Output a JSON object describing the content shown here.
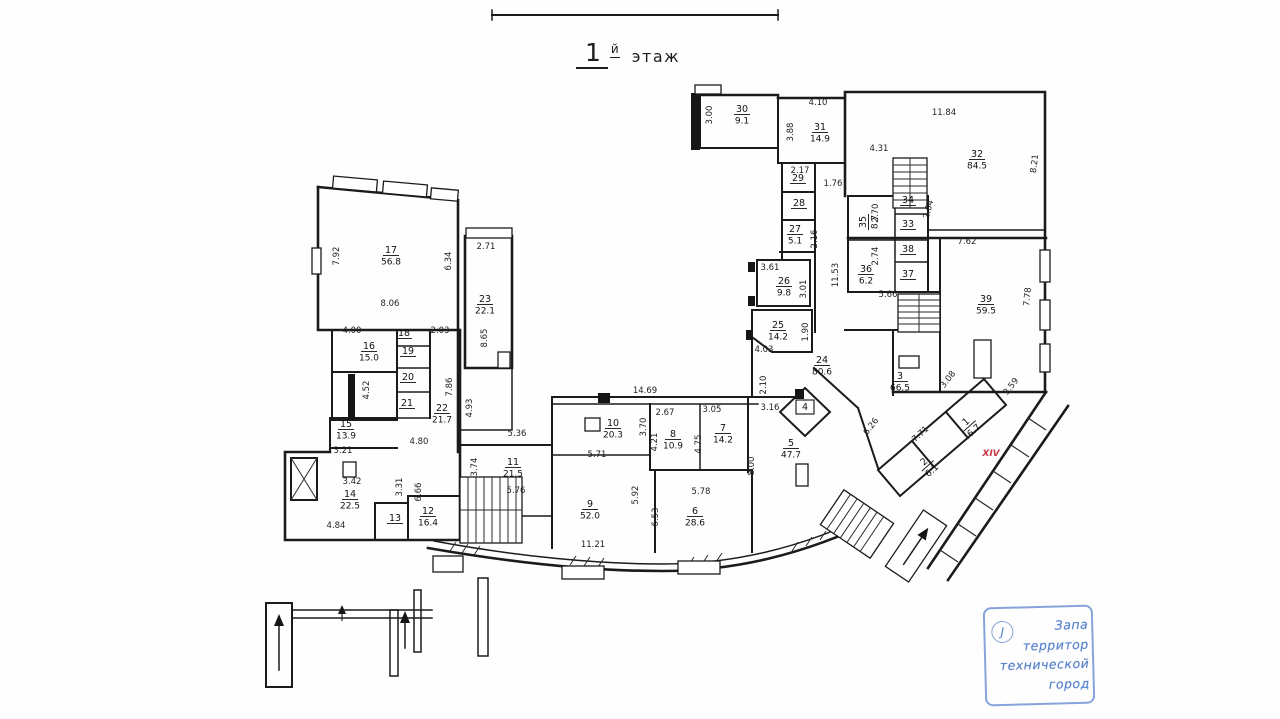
{
  "title": {
    "number": "1",
    "suffix": "й",
    "word": "этаж"
  },
  "colors": {
    "wall": "#1b1b1b",
    "dim_text": "#1f1f1f",
    "accent_red": "#c93545",
    "stamp_blue": "#537fc9"
  },
  "special_labels": [
    {
      "text": "XIV",
      "x": 991,
      "y": 456,
      "color": "#c93545"
    }
  ],
  "stamp": {
    "initial": "J",
    "lines": [
      "Запа",
      "территор",
      "технической",
      "город"
    ]
  },
  "rooms": [
    {
      "n": "1",
      "area": "6.7",
      "x": 968,
      "y": 424,
      "r": -42
    },
    {
      "n": "2",
      "area": "6.1",
      "x": 926,
      "y": 464,
      "r": -42
    },
    {
      "n": "3",
      "area": "66.5",
      "x": 900,
      "y": 379
    },
    {
      "n": "4",
      "area": "",
      "x": 805,
      "y": 410,
      "boxed": true
    },
    {
      "n": "5",
      "area": "47.7",
      "x": 791,
      "y": 446
    },
    {
      "n": "6",
      "area": "28.6",
      "x": 695,
      "y": 514
    },
    {
      "n": "7",
      "area": "14.2",
      "x": 723,
      "y": 431
    },
    {
      "n": "8",
      "area": "10.9",
      "x": 673,
      "y": 437
    },
    {
      "n": "9",
      "area": "52.0",
      "x": 590,
      "y": 507
    },
    {
      "n": "10",
      "area": "20.3",
      "x": 613,
      "y": 426
    },
    {
      "n": "11",
      "area": "21.5",
      "x": 513,
      "y": 465
    },
    {
      "n": "12",
      "area": "16.4",
      "x": 428,
      "y": 514
    },
    {
      "n": "13",
      "area": "",
      "x": 395,
      "y": 521
    },
    {
      "n": "14",
      "area": "22.5",
      "x": 350,
      "y": 497
    },
    {
      "n": "15",
      "area": "13.9",
      "x": 346,
      "y": 427
    },
    {
      "n": "16",
      "area": "15.0",
      "x": 369,
      "y": 349
    },
    {
      "n": "17",
      "area": "56.8",
      "x": 391,
      "y": 253
    },
    {
      "n": "18",
      "area": "",
      "x": 404,
      "y": 336
    },
    {
      "n": "19",
      "area": "",
      "x": 408,
      "y": 354
    },
    {
      "n": "20",
      "area": "",
      "x": 408,
      "y": 380
    },
    {
      "n": "21",
      "area": "",
      "x": 407,
      "y": 406
    },
    {
      "n": "22",
      "area": "21.7",
      "x": 442,
      "y": 411
    },
    {
      "n": "23",
      "area": "22.1",
      "x": 485,
      "y": 302
    },
    {
      "n": "24",
      "area": "80.6",
      "x": 822,
      "y": 363
    },
    {
      "n": "25",
      "area": "14.2",
      "x": 778,
      "y": 328
    },
    {
      "n": "26",
      "area": "9.8",
      "x": 784,
      "y": 284
    },
    {
      "n": "27",
      "area": "5.1",
      "x": 795,
      "y": 232
    },
    {
      "n": "28",
      "area": "",
      "x": 799,
      "y": 206
    },
    {
      "n": "29",
      "area": "",
      "x": 798,
      "y": 181
    },
    {
      "n": "30",
      "area": "9.1",
      "x": 742,
      "y": 112
    },
    {
      "n": "31",
      "area": "14.9",
      "x": 820,
      "y": 130
    },
    {
      "n": "32",
      "area": "84.5",
      "x": 977,
      "y": 157
    },
    {
      "n": "33",
      "area": "",
      "x": 908,
      "y": 227
    },
    {
      "n": "34",
      "area": "",
      "x": 908,
      "y": 203
    },
    {
      "n": "35",
      "area": "8.7",
      "x": 866,
      "y": 222,
      "r": -90
    },
    {
      "n": "36",
      "area": "6.2",
      "x": 866,
      "y": 272
    },
    {
      "n": "37",
      "area": "",
      "x": 908,
      "y": 277
    },
    {
      "n": "38",
      "area": "",
      "x": 908,
      "y": 252
    },
    {
      "n": "39",
      "area": "59.5",
      "x": 986,
      "y": 302
    }
  ],
  "dims": [
    {
      "t": "3.00",
      "x": 712,
      "y": 115,
      "r": -90
    },
    {
      "t": "4.10",
      "x": 818,
      "y": 105
    },
    {
      "t": "3.88",
      "x": 793,
      "y": 132,
      "r": -90
    },
    {
      "t": "11.84",
      "x": 944,
      "y": 115
    },
    {
      "t": "4.31",
      "x": 879,
      "y": 151
    },
    {
      "t": "8.21",
      "x": 1037,
      "y": 164,
      "r": -83
    },
    {
      "t": "2.17",
      "x": 800,
      "y": 173
    },
    {
      "t": "1.76",
      "x": 833,
      "y": 186
    },
    {
      "t": "2.70",
      "x": 878,
      "y": 213,
      "r": -90
    },
    {
      "t": "2.64",
      "x": 931,
      "y": 210,
      "r": -75
    },
    {
      "t": "2.74",
      "x": 878,
      "y": 256,
      "r": -90
    },
    {
      "t": "2.16",
      "x": 817,
      "y": 239,
      "r": -90
    },
    {
      "t": "7.62",
      "x": 967,
      "y": 244
    },
    {
      "t": "3.61",
      "x": 770,
      "y": 270
    },
    {
      "t": "3.01",
      "x": 806,
      "y": 289,
      "r": -90
    },
    {
      "t": "11.53",
      "x": 838,
      "y": 275,
      "r": -90
    },
    {
      "t": "7.78",
      "x": 1030,
      "y": 297,
      "r": -85
    },
    {
      "t": "5.66",
      "x": 888,
      "y": 297
    },
    {
      "t": "1.90",
      "x": 808,
      "y": 332,
      "r": -90
    },
    {
      "t": "4.03",
      "x": 764,
      "y": 352
    },
    {
      "t": "2.10",
      "x": 766,
      "y": 385,
      "r": -90
    },
    {
      "t": "3.08",
      "x": 950,
      "y": 381,
      "r": -52
    },
    {
      "t": "3.59",
      "x": 1013,
      "y": 388,
      "r": -52
    },
    {
      "t": "6.26",
      "x": 873,
      "y": 428,
      "r": -52
    },
    {
      "t": "7.71",
      "x": 922,
      "y": 436,
      "r": -42
    },
    {
      "t": "14.69",
      "x": 645,
      "y": 393
    },
    {
      "t": "2.67",
      "x": 665,
      "y": 415
    },
    {
      "t": "3.05",
      "x": 712,
      "y": 412
    },
    {
      "t": "3.16",
      "x": 770,
      "y": 410
    },
    {
      "t": "4.21",
      "x": 657,
      "y": 442,
      "r": -90
    },
    {
      "t": "4.75",
      "x": 701,
      "y": 444,
      "r": -90
    },
    {
      "t": "8.00",
      "x": 754,
      "y": 466,
      "r": -90
    },
    {
      "t": "5.78",
      "x": 701,
      "y": 494
    },
    {
      "t": "6.53",
      "x": 658,
      "y": 517,
      "r": -90
    },
    {
      "t": "5.92",
      "x": 638,
      "y": 495,
      "r": -90
    },
    {
      "t": "11.21",
      "x": 593,
      "y": 547
    },
    {
      "t": "5.36",
      "x": 517,
      "y": 436
    },
    {
      "t": "5.71",
      "x": 597,
      "y": 457
    },
    {
      "t": "5.76",
      "x": 516,
      "y": 493
    },
    {
      "t": "3.74",
      "x": 477,
      "y": 467,
      "r": -90
    },
    {
      "t": "3.70",
      "x": 646,
      "y": 427,
      "r": -90
    },
    {
      "t": "4.93",
      "x": 472,
      "y": 408,
      "r": -90
    },
    {
      "t": "7.92",
      "x": 339,
      "y": 256,
      "r": -90
    },
    {
      "t": "6.34",
      "x": 451,
      "y": 261,
      "r": -90
    },
    {
      "t": "8.06",
      "x": 390,
      "y": 306
    },
    {
      "t": "2.71",
      "x": 486,
      "y": 249
    },
    {
      "t": "8.65",
      "x": 487,
      "y": 338,
      "r": -90
    },
    {
      "t": "4.00",
      "x": 352,
      "y": 333
    },
    {
      "t": "2.03",
      "x": 440,
      "y": 333
    },
    {
      "t": "7.86",
      "x": 452,
      "y": 387,
      "r": -90
    },
    {
      "t": "4.52",
      "x": 369,
      "y": 390,
      "r": -90
    },
    {
      "t": "3.21",
      "x": 343,
      "y": 453
    },
    {
      "t": "3.42",
      "x": 352,
      "y": 484
    },
    {
      "t": "4.84",
      "x": 336,
      "y": 528
    },
    {
      "t": "4.80",
      "x": 419,
      "y": 444
    },
    {
      "t": "3.31",
      "x": 402,
      "y": 487,
      "r": -90
    },
    {
      "t": "6.66",
      "x": 421,
      "y": 492,
      "r": -90
    }
  ]
}
